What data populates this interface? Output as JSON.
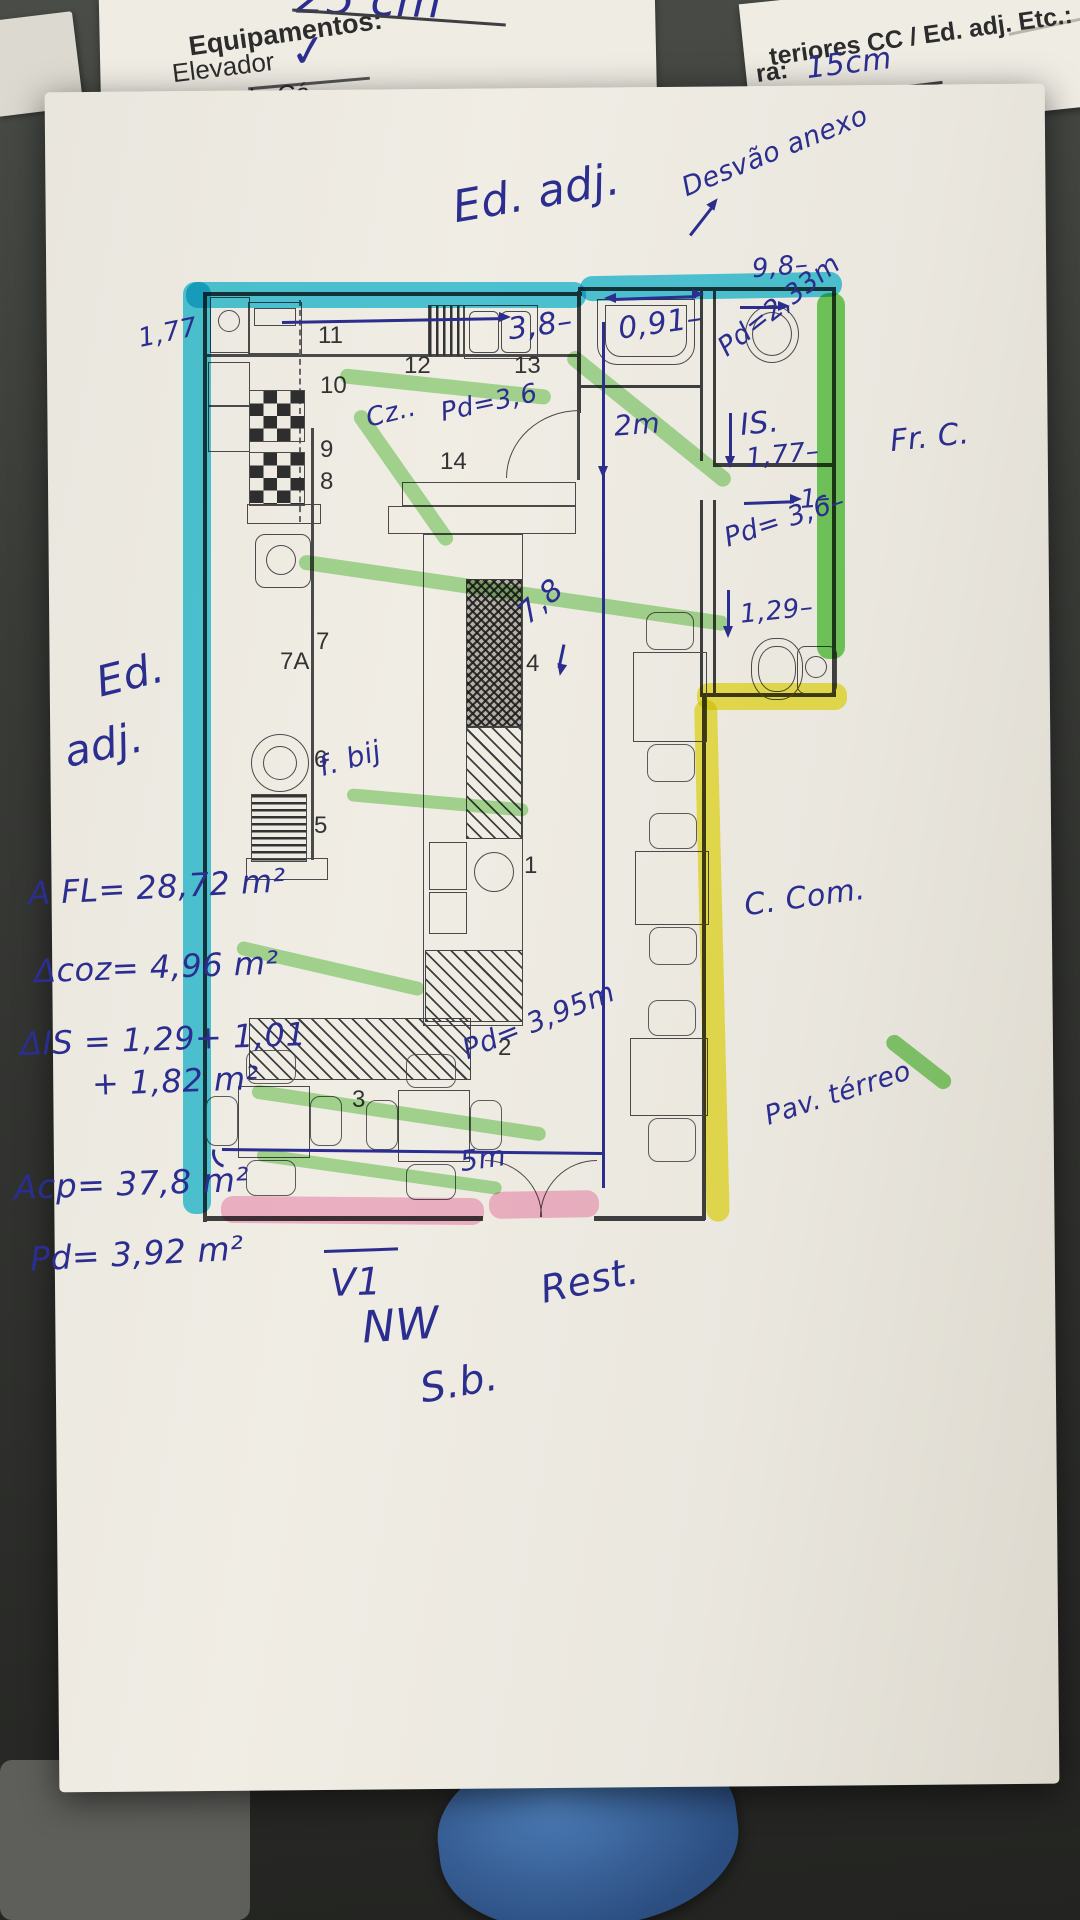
{
  "scene": "photo of hand-annotated floor plan on desk",
  "colors": {
    "ink": "#2b2d8f",
    "highlight_cyan": "#25c5e3",
    "highlight_yellow": "#f0e838",
    "highlight_pink": "#f590bd",
    "highlight_green": "#58c43c",
    "paper": "#ece9e1"
  },
  "back_form": {
    "note_25cm": "25 cm",
    "equip_header": "Equipamentos:",
    "equip_item1": "Elevador",
    "equip_check": "✓",
    "equip_item2": "Rede de Cá",
    "right_line": "teriores CC / Ed. adj. Etc.:",
    "right_field_label": "ra:",
    "right_field_value": "15cm"
  },
  "annotations": {
    "ed_adj_top": "Ed. adj.",
    "desvao": "Desvão anexo",
    "dim_98": "9,8–",
    "left_177": "1,77",
    "kitchen_38": "3,8–",
    "sink_091": "0,91–",
    "pd_233": "Pd=2,33m",
    "cz": "Cz..",
    "pd_36_top": "Pd=3,6",
    "dim_2m": "2m",
    "is_label": "IS.",
    "is_177": "1,77–",
    "fr_c": "Fr. C.",
    "dim_1": "1–",
    "pd_36_mid": "Pd= 3,6–",
    "dim_129": "1,29–",
    "dim_78": "7,8",
    "ed_adj_left_1": "Ed.",
    "ed_adj_left_2": "adj.",
    "f_bij": "f. bij",
    "area_fl": "A FL= 28,72 m²",
    "area_coz": "Δcoz= 4,96 m²",
    "area_is": "ΔIS = 1,29+ 1,01",
    "area_is2": "+ 1,82 m²",
    "area_cp": "Acp=  37,8 m²",
    "pd_392": "Pd= 3,92 m²",
    "c_com": "C. Com.",
    "par_termo": "Pav. térreo",
    "pd_395": "Pd= 3,95m",
    "dim_5m": "5m",
    "v1": "V1",
    "rest": "Rest.",
    "nw": "NW",
    "sb": "S.b."
  },
  "plan": {
    "numbers": {
      "n11": "11",
      "n12": "12",
      "n13": "13",
      "n10": "10",
      "n9": "9",
      "n8": "8",
      "n14": "14",
      "n7": "7",
      "n7a": "7A",
      "n6": "6",
      "n5": "5",
      "n4": "4",
      "n1": "1",
      "n2": "2",
      "n3": "3"
    }
  }
}
